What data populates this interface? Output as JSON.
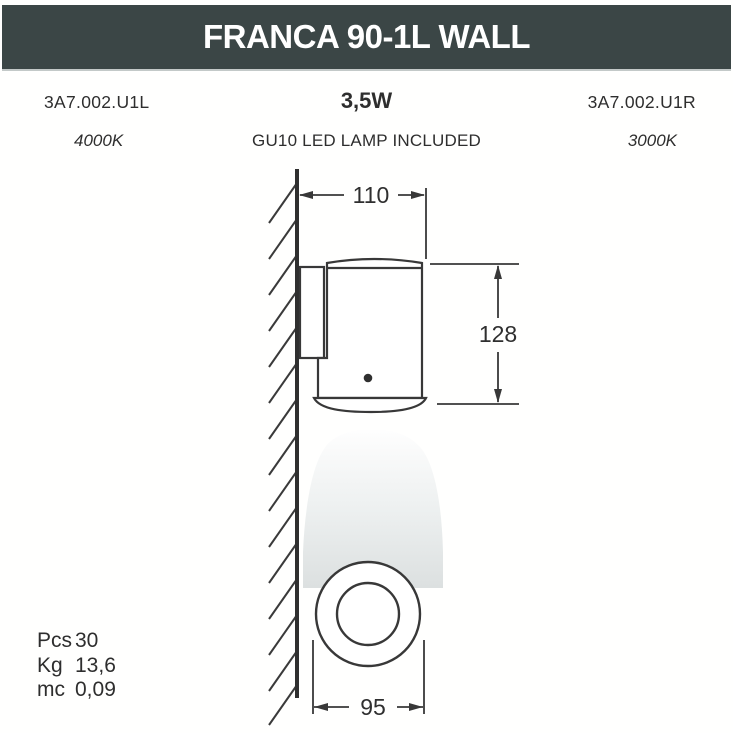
{
  "header": {
    "title": "FRANCA 90-1L WALL",
    "bar_color": "#3b4646",
    "text_color": "#ffffff"
  },
  "specs": {
    "left_code": "3A7.002.U1L",
    "left_temp": "4000K",
    "wattage": "3,5W",
    "lamp_note": "GU10 LED LAMP INCLUDED",
    "right_code": "3A7.002.U1R",
    "right_temp": "3000K"
  },
  "dimensions_mm": {
    "width": "110",
    "height": "128",
    "diameter": "95"
  },
  "packaging": {
    "rows": [
      {
        "label": "Pcs",
        "value": "30"
      },
      {
        "label": "Kg",
        "value": "13,6"
      },
      {
        "label": "mc",
        "value": "0,09"
      }
    ]
  },
  "drawing": {
    "stroke_color": "#383838",
    "beam_top_color": "#fefefe",
    "beam_mid_color": "#edf0f0",
    "beam_bottom_color": "#dce0e0"
  }
}
